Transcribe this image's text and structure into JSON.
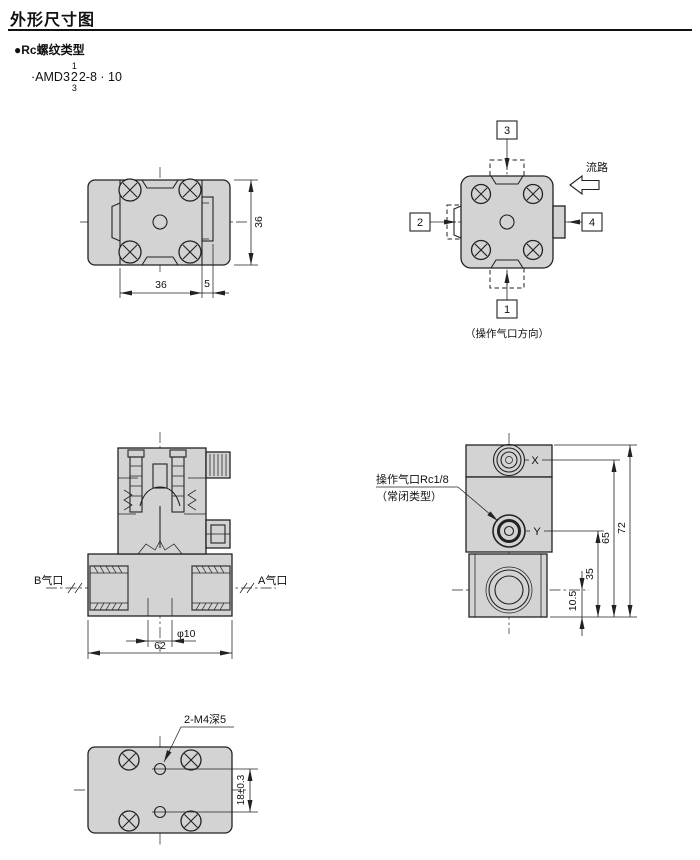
{
  "colors": {
    "body_fill": "#d3d3d3",
    "line": "#222222",
    "background": "#ffffff"
  },
  "header": {
    "title": "外形尺寸图",
    "thread_type": "●Rc螺纹类型",
    "model": {
      "prefix": "·AMD3",
      "stack_top": "1",
      "stack_mid": "2",
      "stack_bottom": "3",
      "suffix": "2-8 · 10"
    }
  },
  "top_view": {
    "dim_width": "36",
    "dim_tab": "5",
    "dim_height": "36"
  },
  "port_direction_view": {
    "port_top": "3",
    "port_left": "2",
    "port_right": "4",
    "port_bottom": "1",
    "flow_label": "流路",
    "caption": "（操作气口方向）"
  },
  "cross_section_view": {
    "port_b": "B气口",
    "port_a": "A气口",
    "dim_bore": "φ10",
    "dim_width": "62"
  },
  "side_view": {
    "pilot_label_line1": "操作气口Rc1/8",
    "pilot_label_line2": "（常闭类型）",
    "port_x": "X",
    "port_y": "Y",
    "dim_x_height": "65",
    "dim_total_height": "72",
    "dim_y_height": "35",
    "dim_bottom_port_height": "10.5"
  },
  "bottom_view": {
    "thread_label": "2-M4深5",
    "dim_hole_pitch": "18±0.3"
  }
}
